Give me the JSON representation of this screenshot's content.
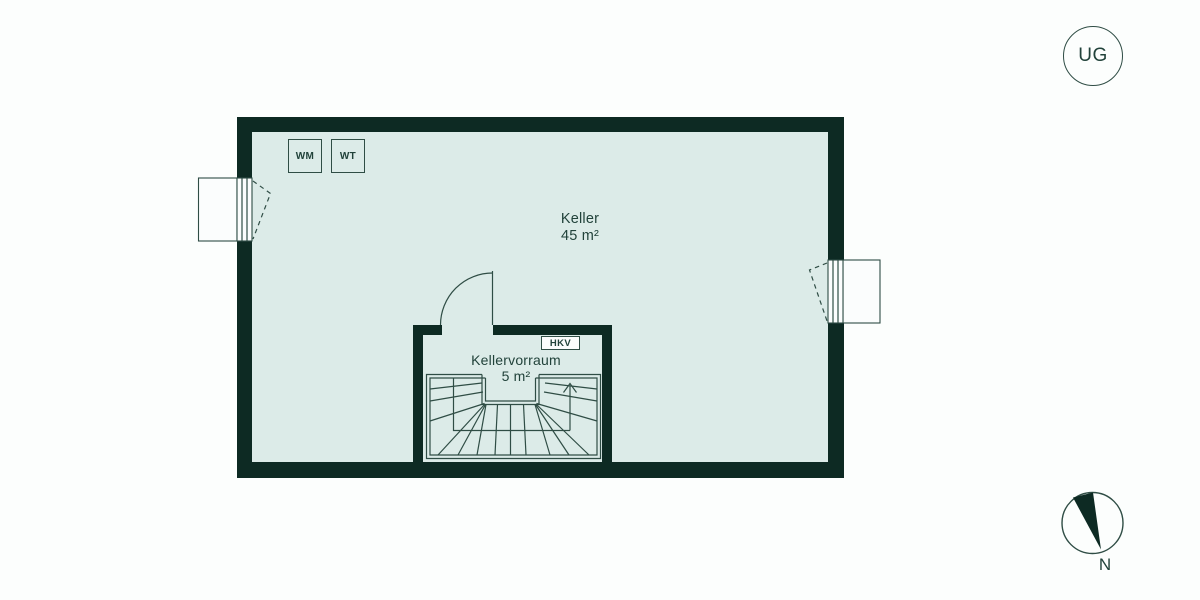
{
  "floor_badge": {
    "label": "UG"
  },
  "compass": {
    "north_label": "N"
  },
  "rooms": {
    "keller": {
      "name": "Keller",
      "area": "45 m²"
    },
    "kellervorraum": {
      "name": "Kellervorraum",
      "area": "5 m²"
    }
  },
  "fixtures": {
    "washing_machine": "WM",
    "dryer": "WT",
    "heating_distributor": "HKV"
  },
  "colors": {
    "wall": "#0d2a23",
    "room_fill": "#dcebe8",
    "line": "#2f4d45",
    "text": "#21423a",
    "background": "#fcfefd",
    "window_fill": "#fbfdfd"
  }
}
